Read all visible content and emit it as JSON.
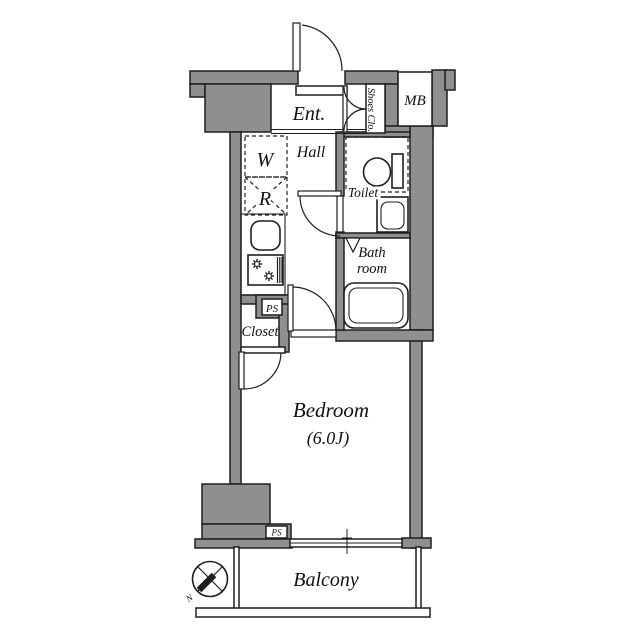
{
  "floorplan": {
    "rooms": {
      "entrance": "Ent.",
      "shoes_closet": "Shoes Clo.",
      "meter_box": "MB",
      "hall": "Hall",
      "washer": "W",
      "refrigerator": "R",
      "toilet": "Toilet",
      "bath_line1": "Bath",
      "bath_line2": "room",
      "pipe_space_upper": "PS",
      "closet": "Closet",
      "bedroom": "Bedroom",
      "bedroom_size": "(6.0J)",
      "pipe_space_lower": "PS",
      "balcony": "Balcony"
    },
    "compass": {
      "north": "N"
    },
    "colors": {
      "wall": "#8f8f8f",
      "line": "#1f1f1f",
      "background": "#ffffff",
      "text": "#111111"
    }
  }
}
